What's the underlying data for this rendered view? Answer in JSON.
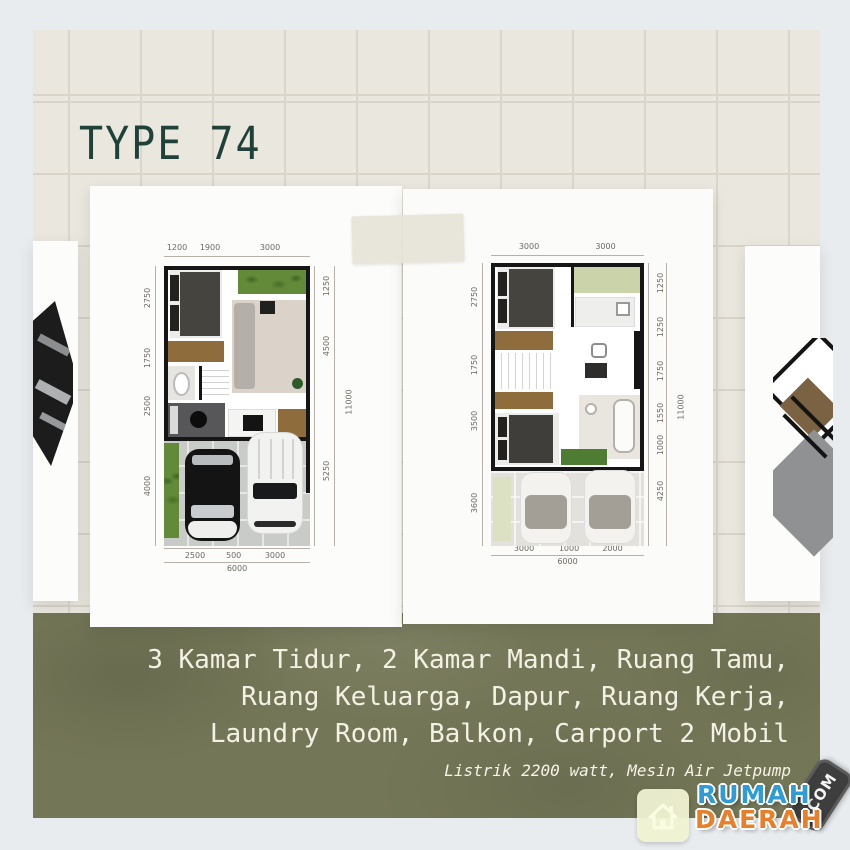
{
  "title": "TYPE 74",
  "description": {
    "line1": "3 Kamar Tidur, 2 Kamar Mandi, Ruang Tamu,",
    "line2": "Ruang Keluarga, Dapur, Ruang Kerja,",
    "line3": "Laundry Room, Balkon, Carport 2 Mobil",
    "note": "Listrik 2200 watt, Mesin Air Jetpump"
  },
  "logo": {
    "word1": "RUMAH",
    "word2": "DAERAH",
    "tld": ".COM",
    "colors": {
      "word1": "#2f9cd8",
      "word2": "#e8802b",
      "tag_bg": "#3e3e3e",
      "tile_bg": "#f0f2d2"
    }
  },
  "plans": {
    "floor1": {
      "dims_top": [
        "1200",
        "1900",
        "3000"
      ],
      "dims_left": [
        "2750",
        "1750",
        "2500",
        "4000"
      ],
      "dims_right": [
        "1250",
        "4500",
        "5250"
      ],
      "dim_right_total": "11000",
      "dims_bottom": [
        "2500",
        "500",
        "3000"
      ],
      "dim_bottom_total": "6000"
    },
    "floor2": {
      "dims_top": [
        "3000",
        "3000"
      ],
      "dims_left": [
        "2750",
        "1750",
        "3500",
        "3600"
      ],
      "dims_right": [
        "1250",
        "1250",
        "1750",
        "1550",
        "1000",
        "4250"
      ],
      "dim_right_total": "11000",
      "dims_bottom": [
        "3000",
        "1000",
        "2000"
      ],
      "dim_bottom_total": "6000"
    }
  },
  "palette": {
    "frame": "#e9ecef",
    "tile": "#eae7df",
    "grout": "#dad6cb",
    "olive": "#747757",
    "title": "#20413a",
    "text": "#f3f1e4",
    "wall": "#161616"
  }
}
